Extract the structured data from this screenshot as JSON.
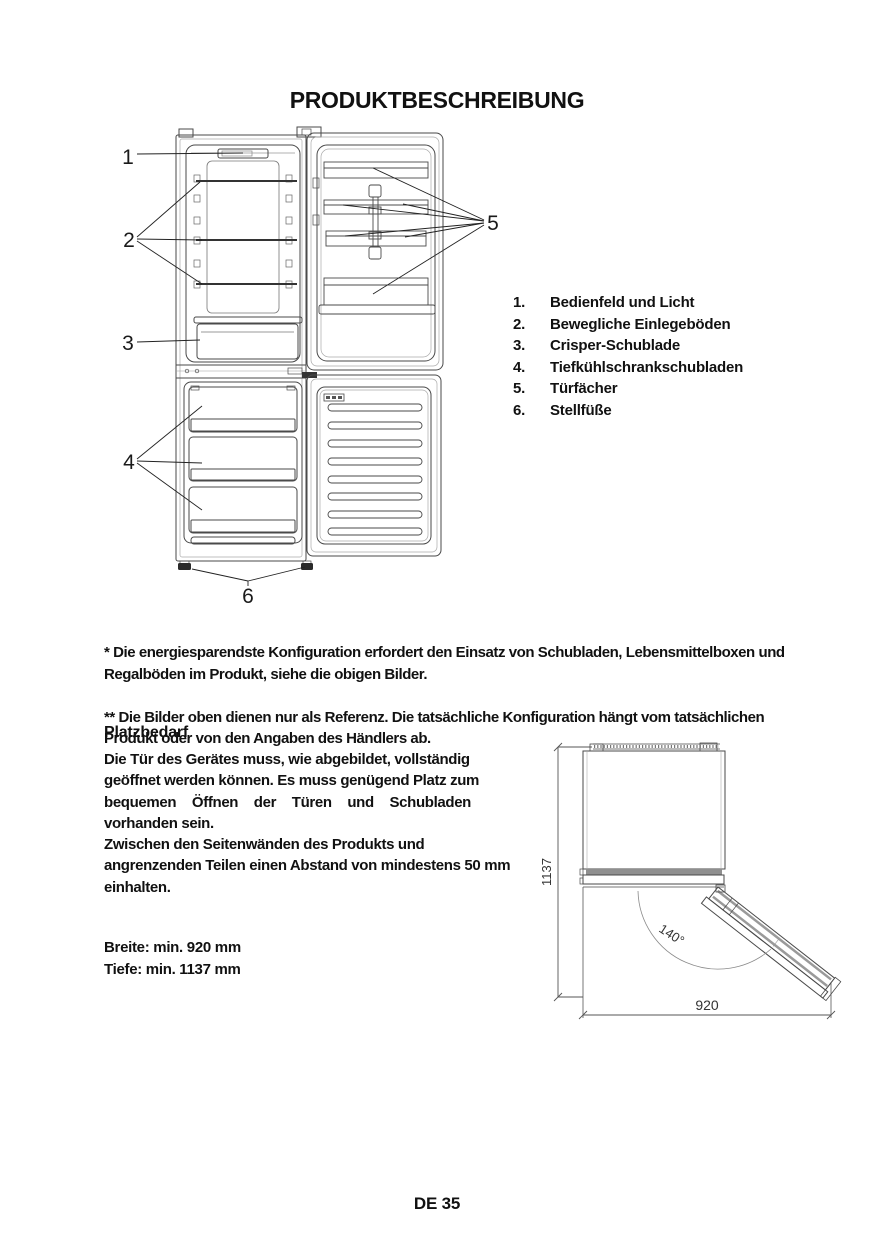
{
  "colors": {
    "ink": "#111111",
    "drawing_line": "#4a4a4a",
    "light_line": "#999999",
    "door_band_gray": "#8f8f8f"
  },
  "title": "PRODUKTBESCHREIBUNG",
  "parts_list": {
    "items": [
      {
        "num": "1.",
        "label": "Bedienfeld und Licht"
      },
      {
        "num": "2.",
        "label": "Bewegliche Einlegeböden"
      },
      {
        "num": "3.",
        "label": "Crisper-Schublade"
      },
      {
        "num": "4.",
        "label": "Tiefkühlschrankschubladen"
      },
      {
        "num": "5.",
        "label": "Türfächer"
      },
      {
        "num": "6.",
        "label": "Stellfüße"
      }
    ]
  },
  "fridge_figure": {
    "callouts": {
      "c1": "1",
      "c2": "2",
      "c3": "3",
      "c4": "4",
      "c5": "5",
      "c6": "6"
    }
  },
  "footnotes": {
    "fn1": "* Die energiesparendste Konfiguration erfordert den Einsatz von Schubladen, Lebensmittelboxen und\nRegalböden im Produkt, siehe die obigen Bilder.",
    "fn2": "** Die Bilder oben dienen nur als Referenz. Die tatsächliche Konfiguration hängt vom tatsächlichen\nProdukt oder von den Angaben des Händlers ab."
  },
  "platzbedarf": {
    "heading": "Platzbedarf",
    "p1_lines": [
      "Die Tür des Gerätes muss, wie abgebildet, vollständig",
      "geöffnet werden können. Es muss genügend Platz zum",
      "bequemen Öffnen der Türen und Schubladen",
      "vorhanden sein."
    ],
    "p2_lines": [
      "Zwischen den Seitenwänden des Produkts und",
      "angrenzenden Teilen einen Abstand von mindestens 50 mm",
      "einhalten."
    ],
    "breite": "Breite: min. 920 mm",
    "tiefe": "Tiefe: min. 1137 mm"
  },
  "space_diagram": {
    "depth": "1137",
    "width": "920",
    "angle": "140°"
  },
  "footer": {
    "page": "DE 35"
  }
}
